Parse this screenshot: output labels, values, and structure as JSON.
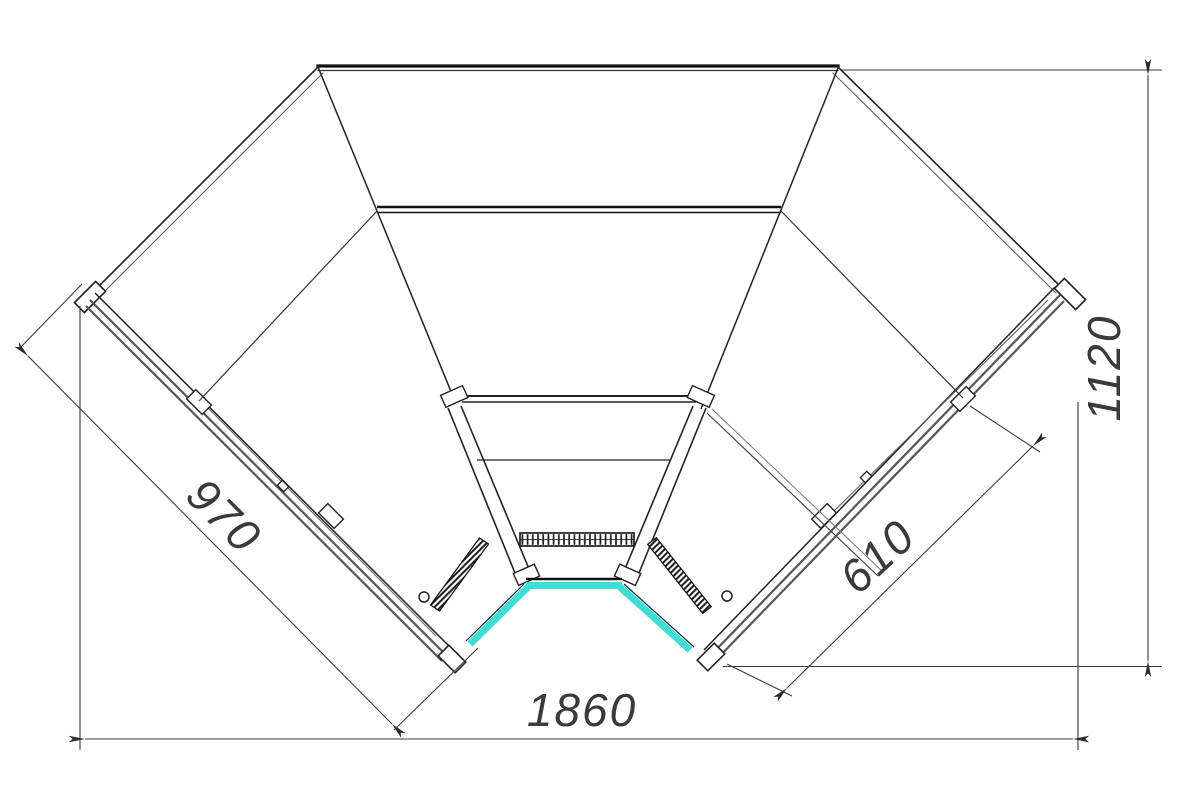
{
  "drawing": {
    "title": "corner-display-case-plan-view",
    "dimensions": {
      "overall_width": {
        "value": "1860",
        "orientation": "horizontal",
        "position": "bottom"
      },
      "overall_depth": {
        "value": "1120",
        "orientation": "vertical",
        "position": "right"
      },
      "left_front_length": {
        "value": "970",
        "orientation": "diagonal-45",
        "position": "left-wing"
      },
      "right_front_length": {
        "value": "610",
        "orientation": "diagonal-135",
        "position": "right-wing"
      }
    },
    "colors": {
      "line": "#222222",
      "rail_gray": "#555555",
      "dim_line": "#3a3a3a",
      "highlight_cyan": "#3ae0d4",
      "background": "#ffffff"
    }
  }
}
